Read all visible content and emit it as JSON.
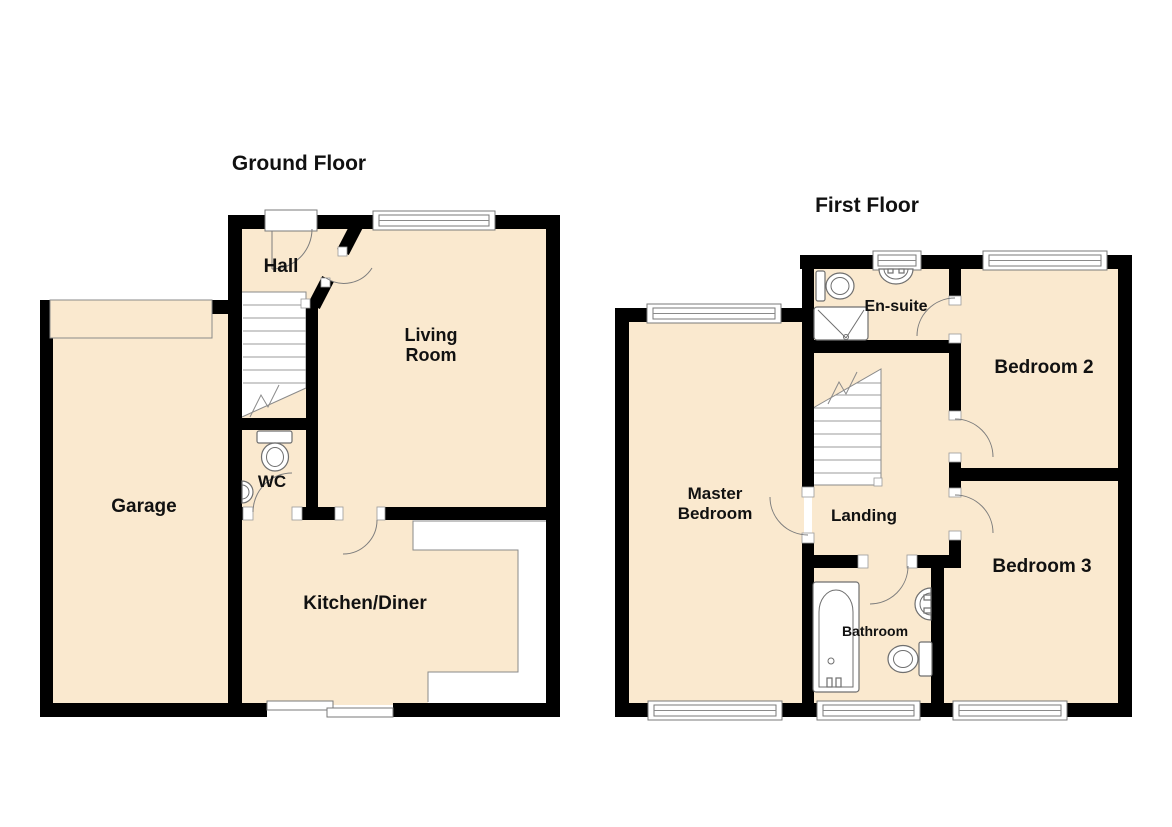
{
  "canvas": {
    "width": 1172,
    "height": 827
  },
  "colors": {
    "wall": "#000000",
    "floor": "#fae9cf",
    "line": "#8a8a8a",
    "fixture": "#6f6f6f",
    "text": "#111111"
  },
  "ground_floor": {
    "title": "Ground Floor",
    "rooms": {
      "hall": "Hall",
      "living_room": {
        "line1": "Living",
        "line2": "Room"
      },
      "garage": "Garage",
      "wc": "WC",
      "kitchen_diner": "Kitchen/Diner"
    },
    "fixture_icons": [
      "staircase-icon",
      "entry-door-icon",
      "window-icon",
      "sliding-patio-door-icon",
      "garage-door-icon",
      "toilet-icon",
      "basin-icon"
    ]
  },
  "first_floor": {
    "title": "First Floor",
    "rooms": {
      "ensuite": "En-suite",
      "bedroom2": "Bedroom 2",
      "master_bedroom": {
        "line1": "Master",
        "line2": "Bedroom"
      },
      "landing": "Landing",
      "bedroom3": "Bedroom 3",
      "bathroom": "Bathroom"
    },
    "fixture_icons": [
      "staircase-icon",
      "window-icon",
      "shower-icon",
      "toilet-icon",
      "basin-icon",
      "bath-icon"
    ]
  }
}
